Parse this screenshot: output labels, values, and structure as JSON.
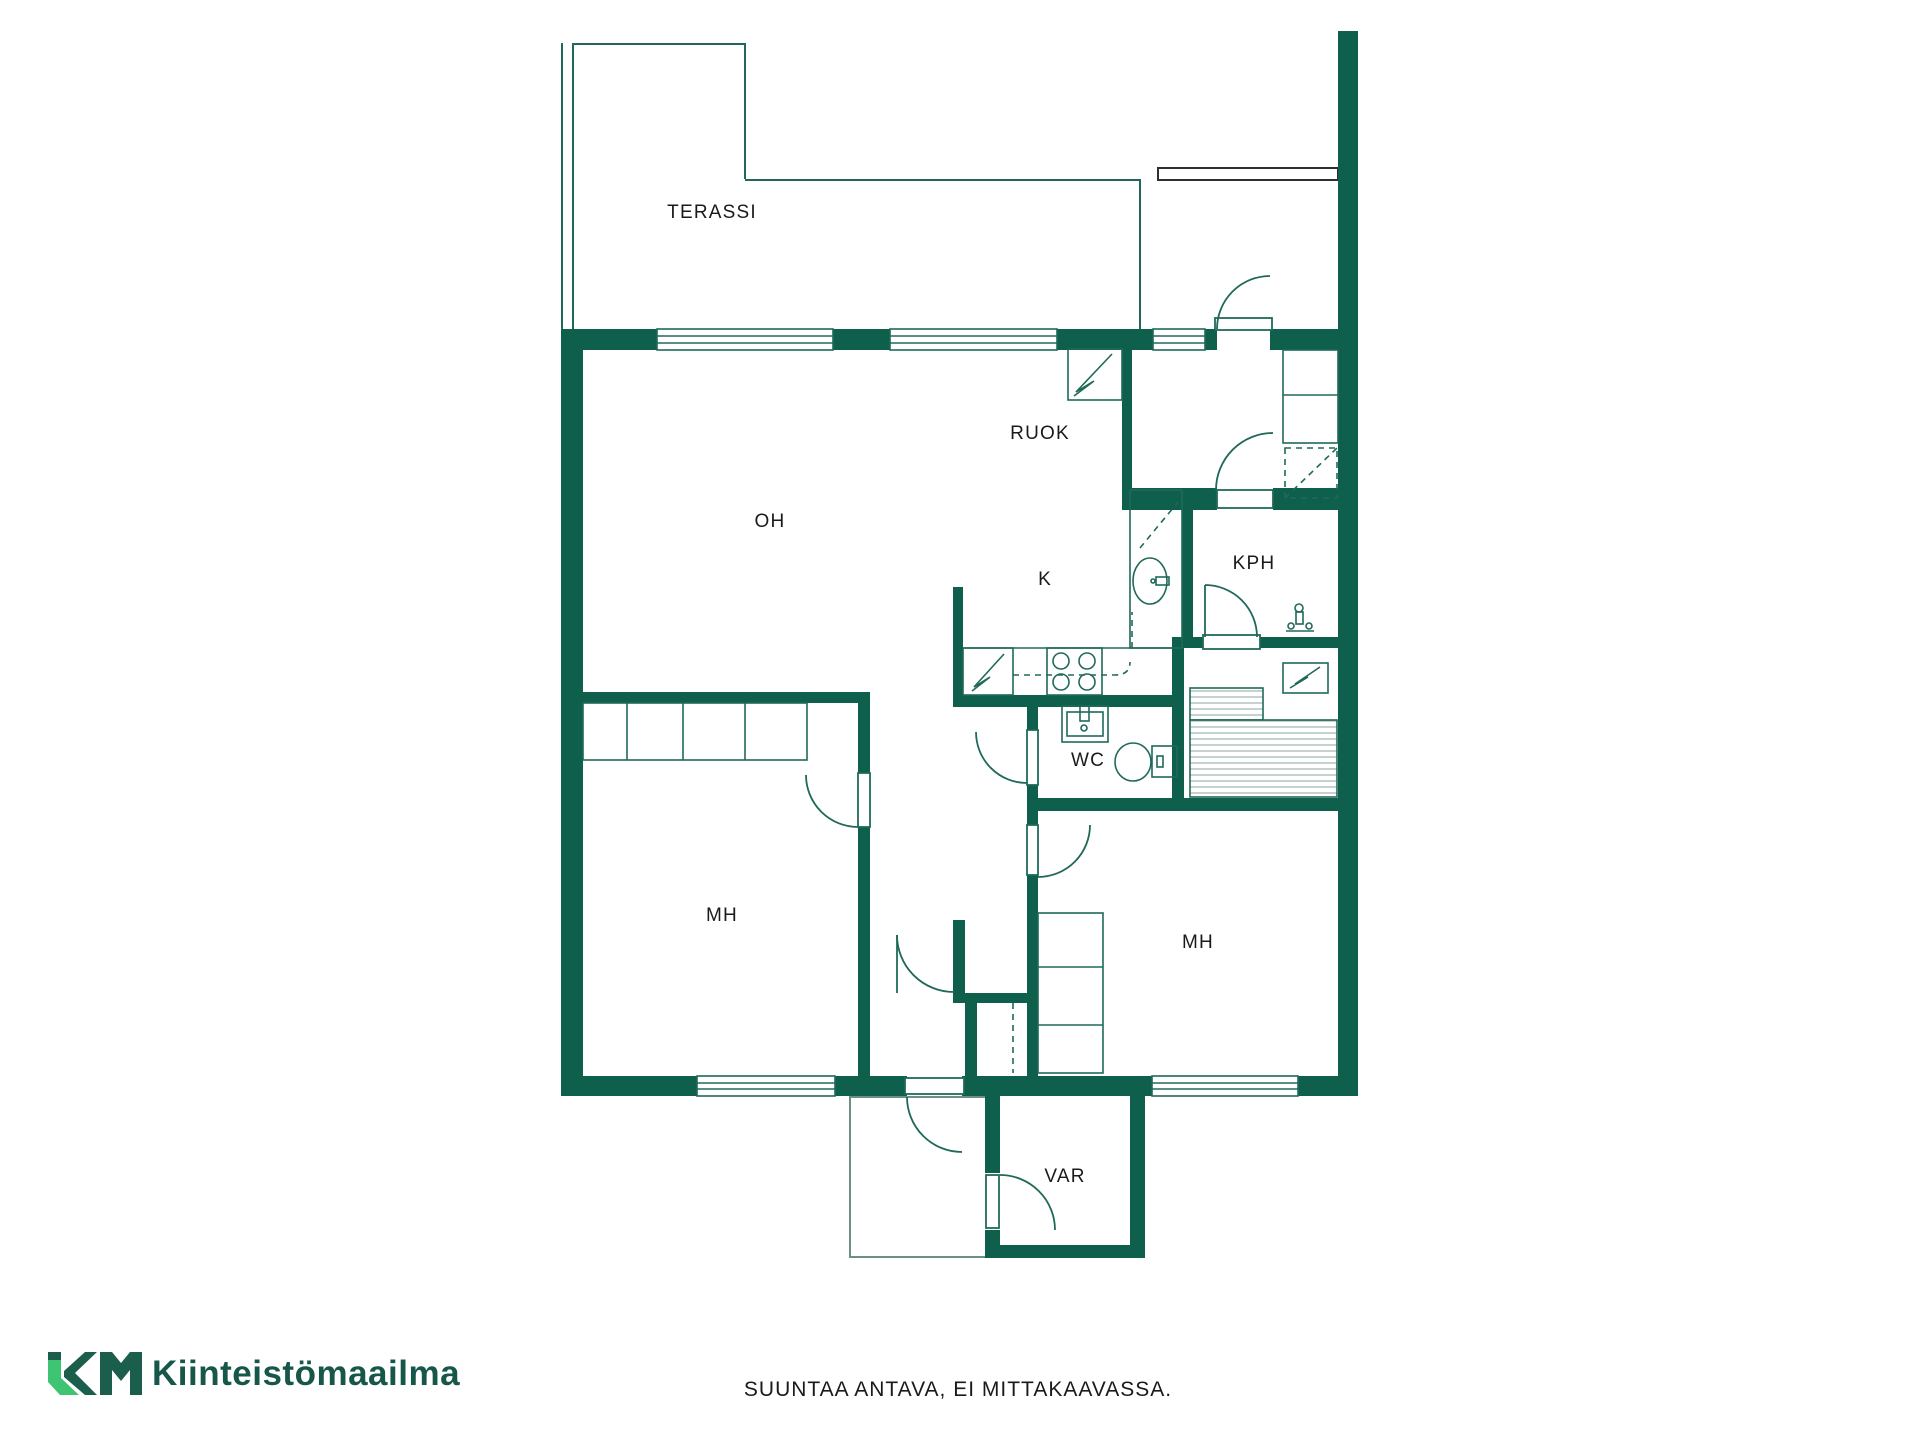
{
  "title": "Floor plan",
  "colors": {
    "wall": "#0F5F4D",
    "thin_line": "#20695A",
    "outside_line": "#6E8F85",
    "porch_outline": "#2F2F2F",
    "logo_light_green": "#3FC474",
    "logo_dark_green": "#1B5E4B",
    "logo_text_color": "#16574A"
  },
  "rooms": {
    "terassi": "TERASSI",
    "ruok": "RUOK",
    "oh": "OH",
    "k": "K",
    "kph": "KPH",
    "wc": "WC",
    "mh_left": "MH",
    "mh_right": "MH",
    "var": "VAR"
  },
  "footer": {
    "brand": "Kiinteistömaailma",
    "disclaimer": "SUUNTAA ANTAVA, EI MITTAKAAVASSA."
  }
}
